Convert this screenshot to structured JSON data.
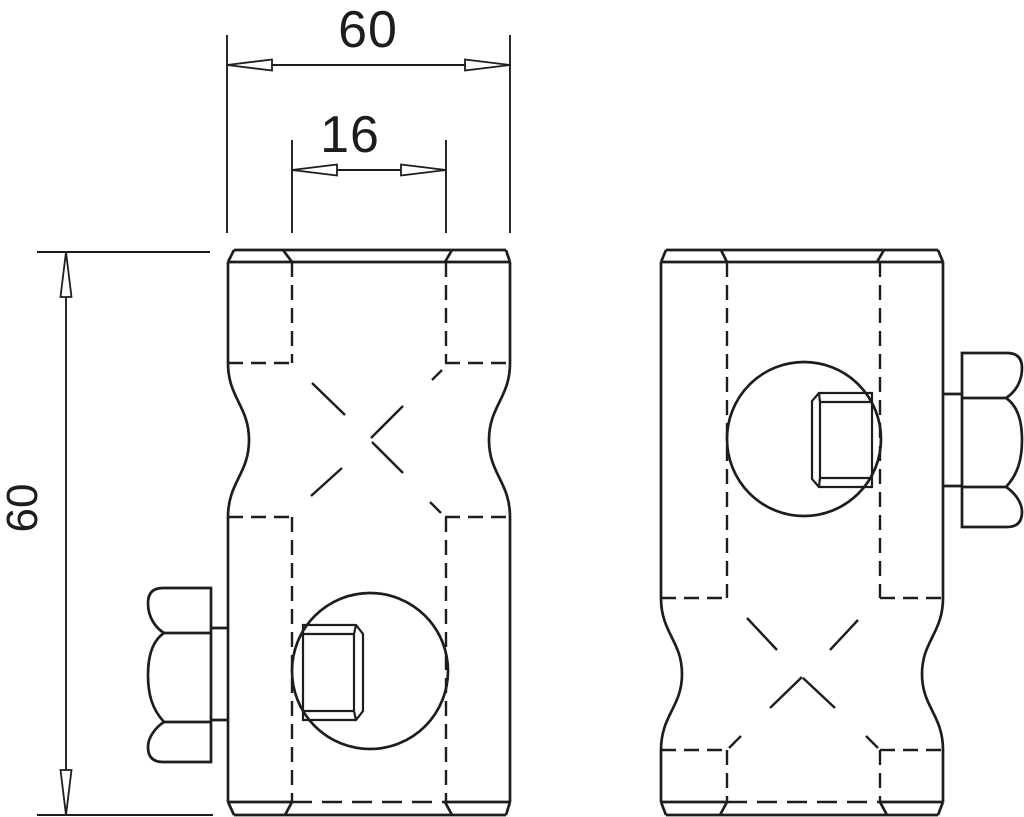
{
  "drawing": {
    "background_color": "#ffffff",
    "line_color": "#1d1d1d"
  },
  "dimensions": {
    "overall_width": {
      "label": "60"
    },
    "bore_width": {
      "label": "16"
    },
    "overall_height": {
      "label": "60"
    }
  }
}
